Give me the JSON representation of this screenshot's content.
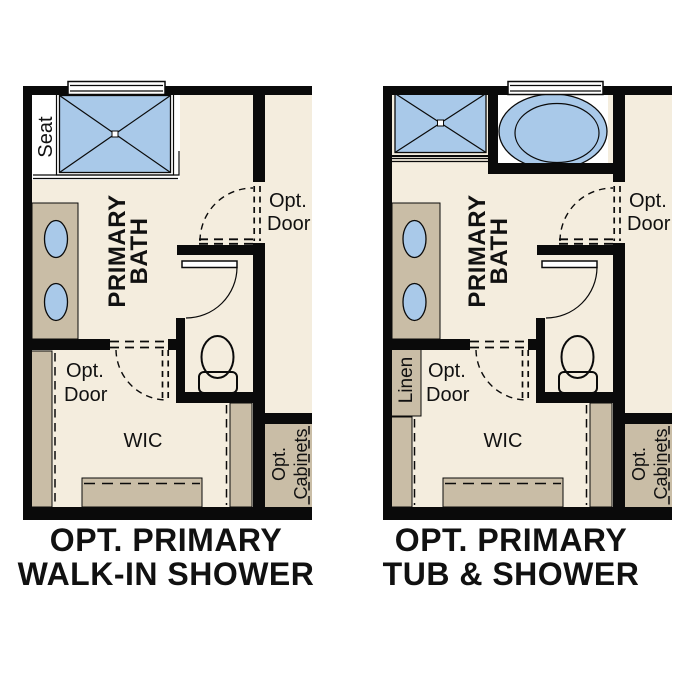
{
  "colors": {
    "canvas": "#ffffff",
    "floor": "#f4edde",
    "wall": "#0a0a0a",
    "fixture_tan": "#c9bda6",
    "fixture_blue": "#a9c9e9",
    "text": "#111111"
  },
  "plans": [
    {
      "name": "opt-primary-walk-in-shower",
      "title": [
        "OPT. PRIMARY",
        "WALK-IN SHOWER"
      ],
      "room_label": [
        "PRIMARY",
        "BATH"
      ],
      "seat_label": "Seat",
      "bath_door_label": [
        "Opt.",
        "Door"
      ],
      "wic_door_label": [
        "Opt.",
        "Door"
      ],
      "wic_label": "WIC",
      "cabinets_label": [
        "Opt.",
        "Cabinets"
      ]
    },
    {
      "name": "opt-primary-tub-and-shower",
      "title": [
        "OPT. PRIMARY",
        "TUB & SHOWER"
      ],
      "room_label": [
        "PRIMARY",
        "BATH"
      ],
      "linen_label": "Linen",
      "bath_door_label": [
        "Opt.",
        "Door"
      ],
      "wic_door_label": [
        "Opt.",
        "Door"
      ],
      "wic_label": "WIC",
      "cabinets_label": [
        "Opt.",
        "Cabinets"
      ]
    }
  ]
}
